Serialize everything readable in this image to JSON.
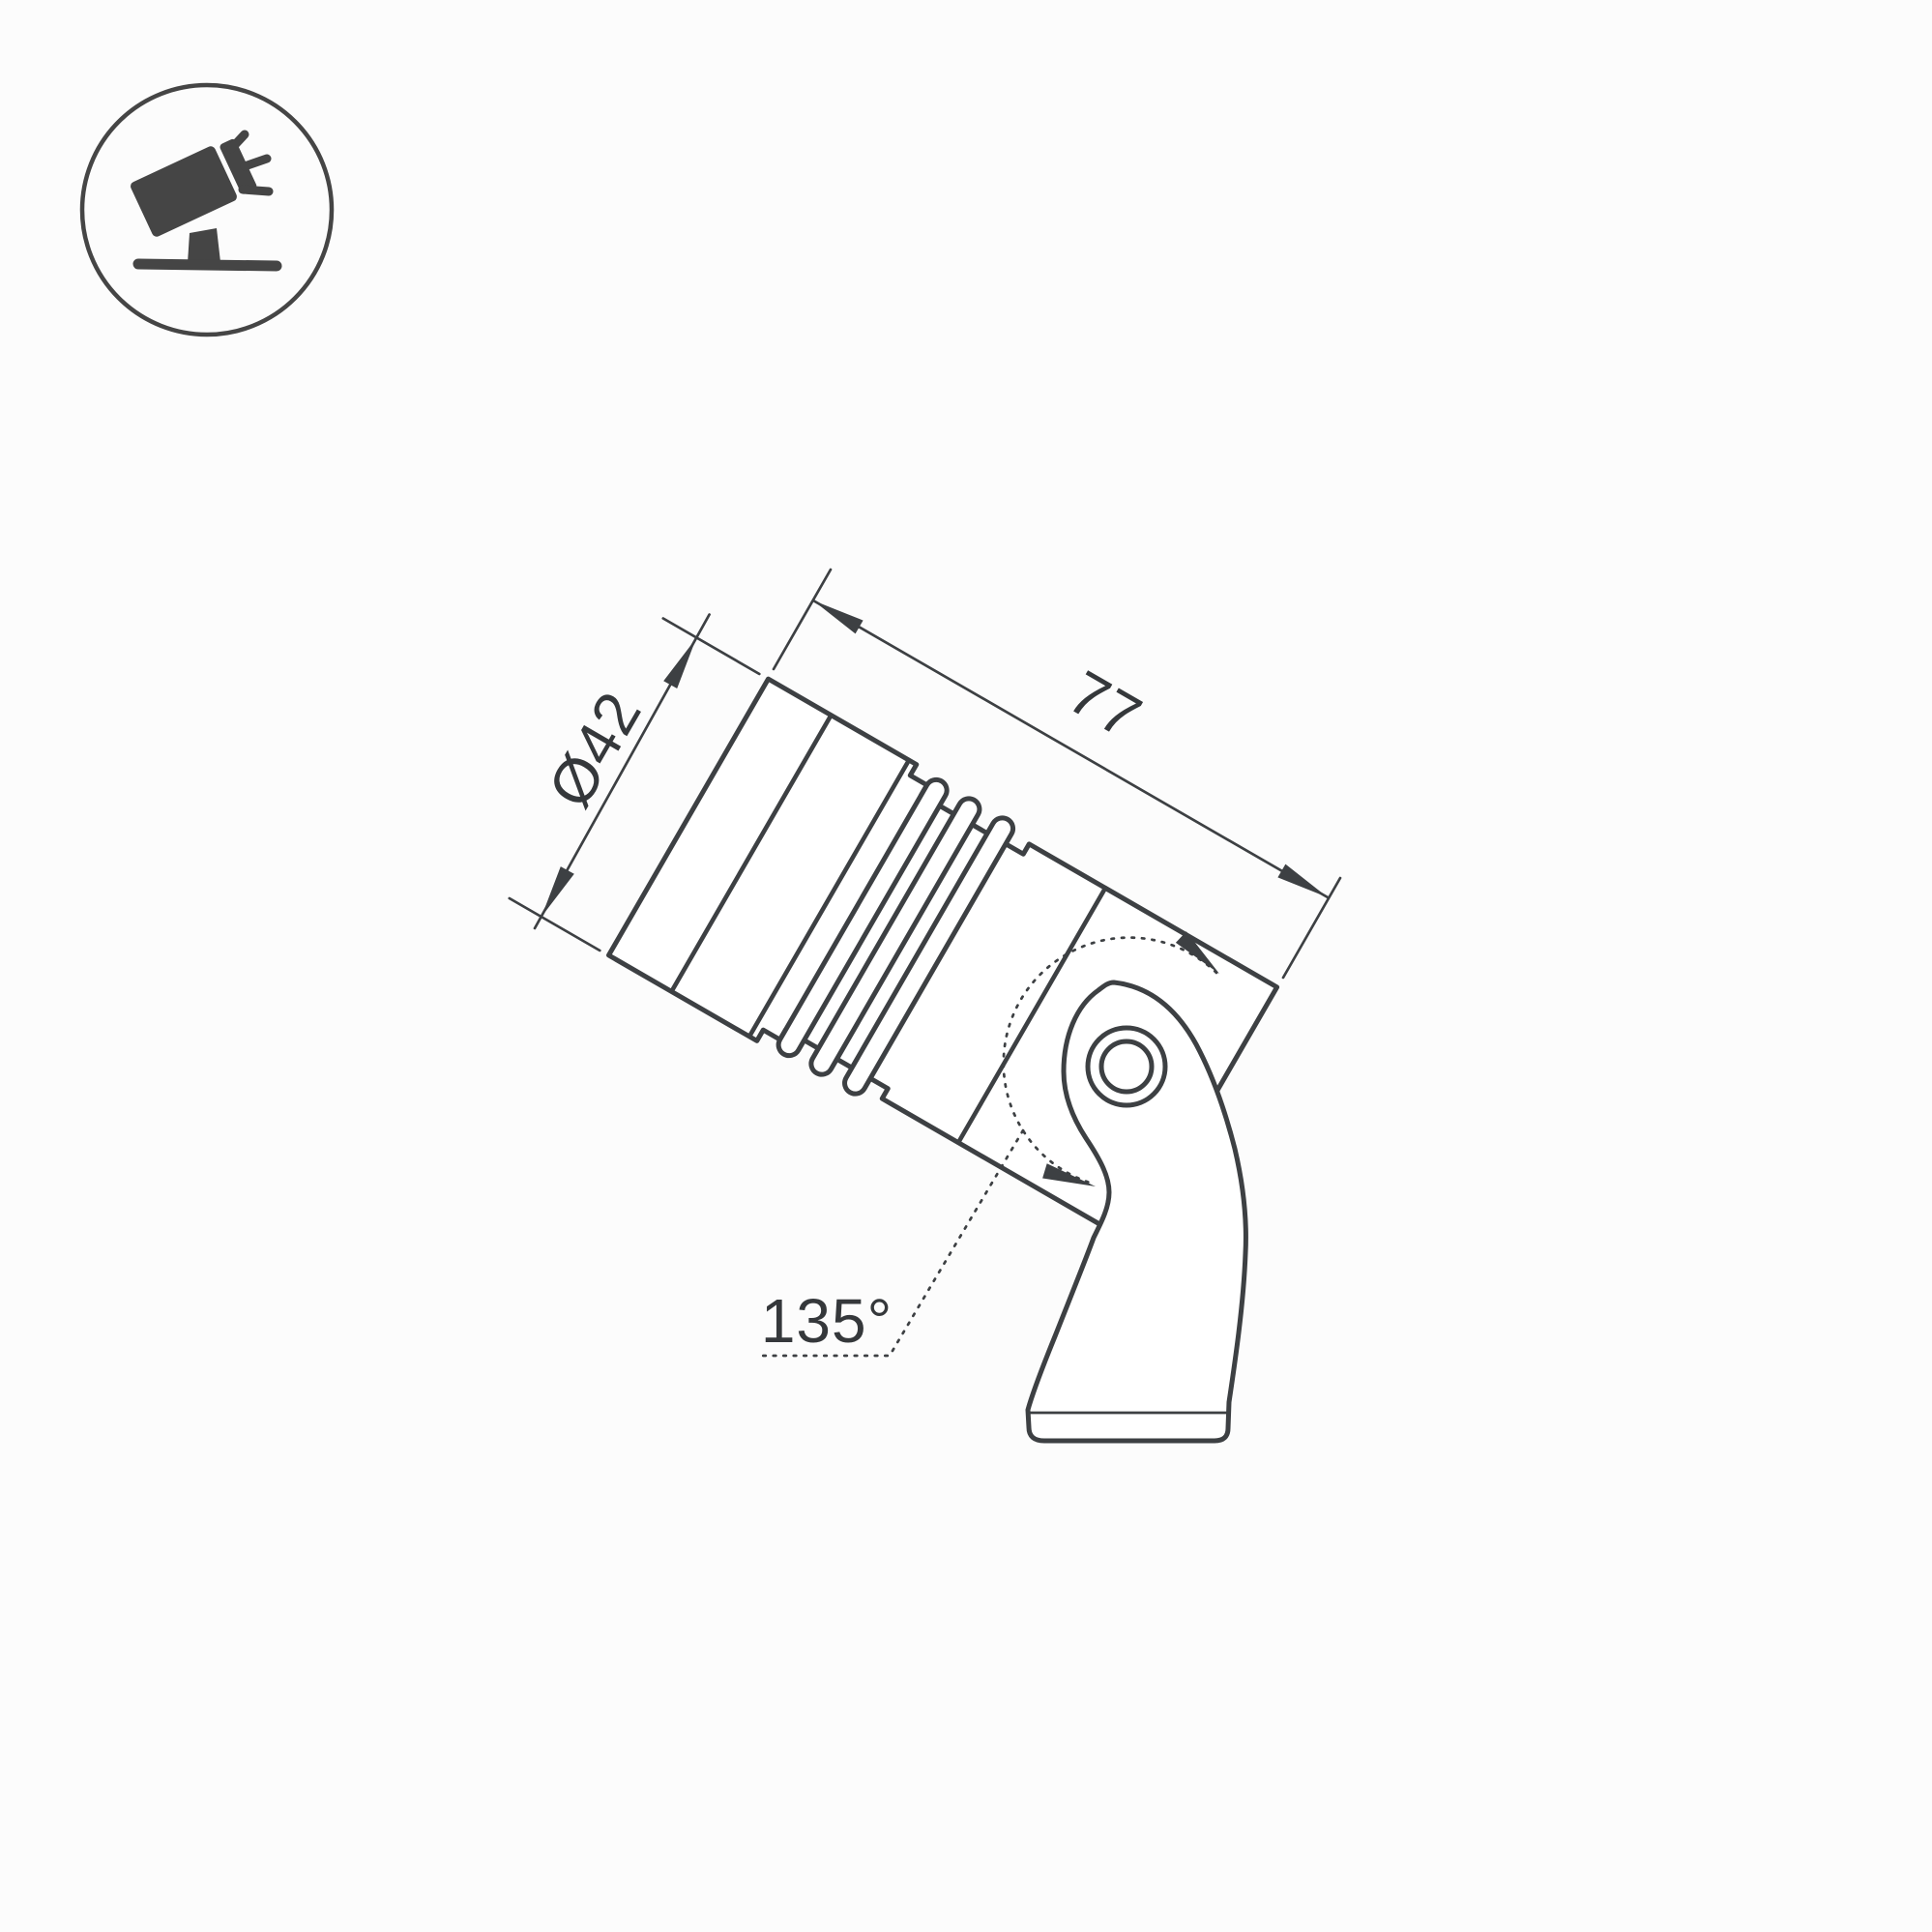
{
  "drawing": {
    "kind": "technical-dimension-drawing",
    "dimensions": {
      "diameter_label": "Ø42",
      "diameter_value_mm": 42,
      "length_label": "77",
      "length_value_mm": 77,
      "angle_label": "135°",
      "angle_value_deg": 135
    },
    "icon": {
      "name": "tilted-spotlight-icon"
    },
    "colors": {
      "line": "#3d4043",
      "text": "#35383b",
      "background": "#fcfcfc",
      "shape_fill": "#ffffff",
      "icon_fill": "#454545"
    }
  }
}
